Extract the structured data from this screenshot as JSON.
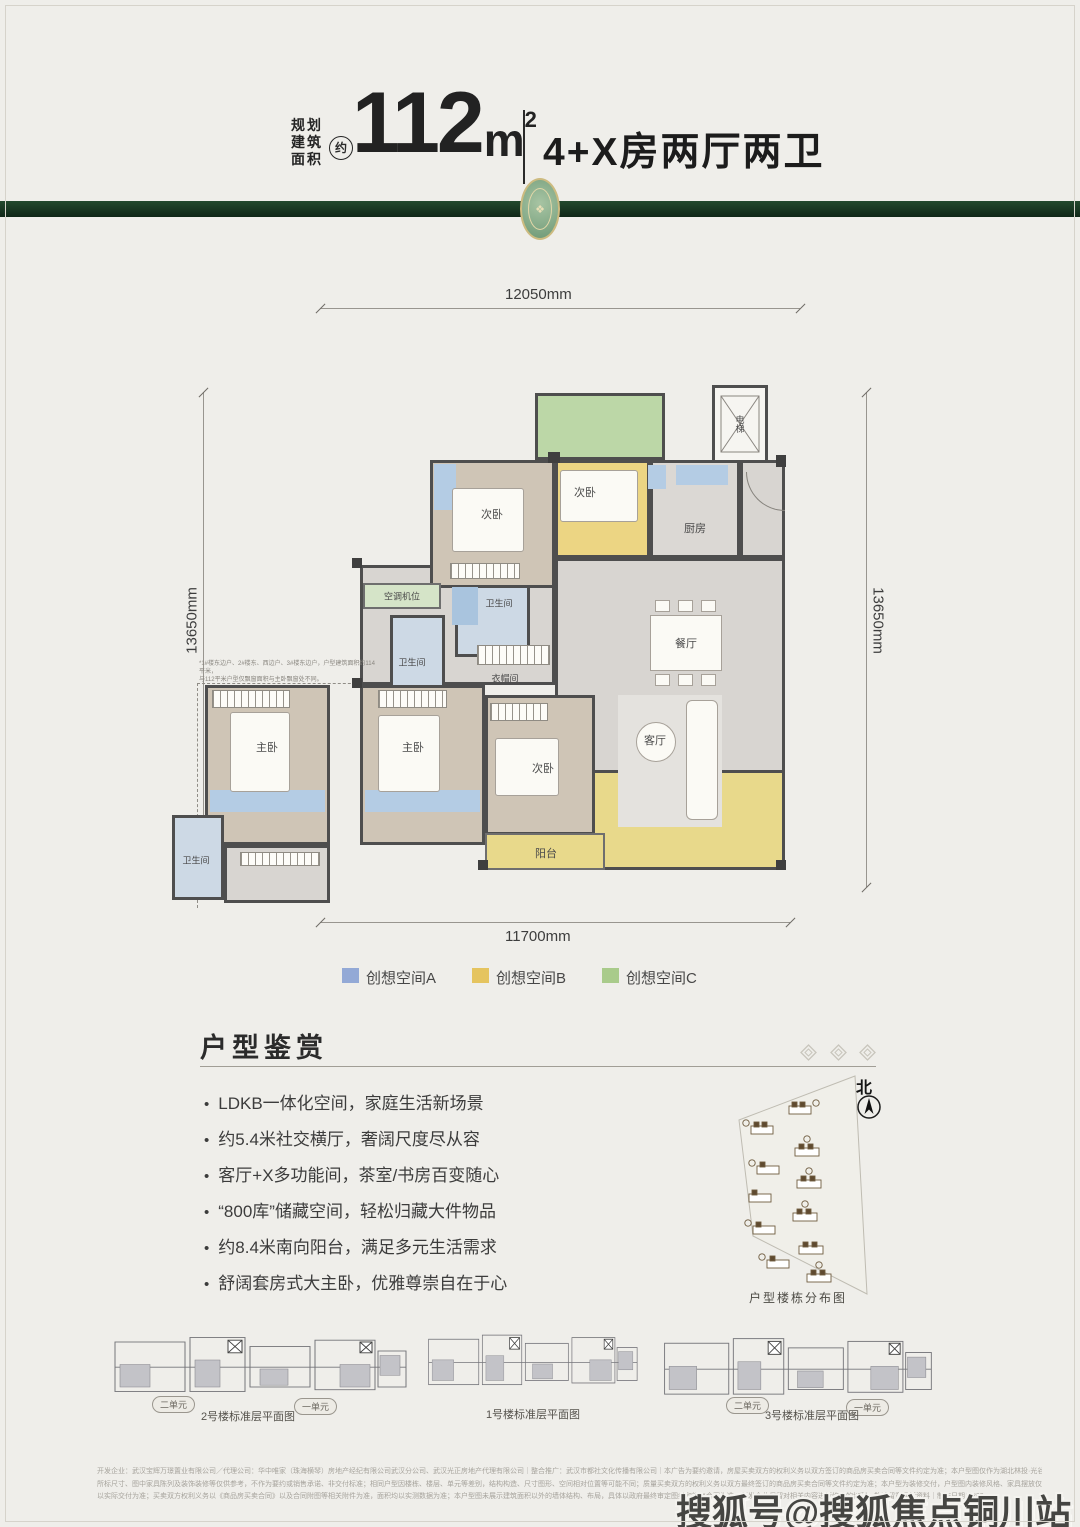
{
  "header": {
    "area_label": [
      "规划",
      "建筑",
      "面积"
    ],
    "approx_badge": "约",
    "area_value": "112",
    "area_unit": "m",
    "area_exp": "2",
    "layout_title": "4+X房两厅两卫"
  },
  "colors": {
    "band_green": "#1b3a24",
    "space_a_blue": "#93a9d6",
    "space_b_yellow": "#e5c45f",
    "space_c_green": "#a9cb8b",
    "wall": "#4e4e4e"
  },
  "floorplan": {
    "dims": {
      "top": "12050mm",
      "left": "13650mm",
      "right": "13650mm",
      "bottom": "11700mm"
    },
    "rooms": {
      "bedroom_left": "次卧",
      "bedroom_yellow": "次卧",
      "kitchen": "厨房",
      "elevator": "电梯",
      "ac_unit": "空调机位",
      "bath_upper": "卫生间",
      "bath_lower": "卫生间",
      "bath_alt": "卫生间",
      "cloakroom": "衣帽间",
      "dining": "餐厅",
      "living": "客厅",
      "master_alt": "主卧",
      "master": "主卧",
      "bedroom_lower": "次卧",
      "balcony": "阳台"
    },
    "note_lines": [
      "*1#楼东边户、2#楼东、西边户、3#楼东边户，户型建筑面积约114平米，",
      "与112平米户型仅飘窗面积与主卧飘窗处不同。"
    ]
  },
  "legend": {
    "items": [
      {
        "label": "创想空间A",
        "color": "#93a9d6"
      },
      {
        "label": "创想空间B",
        "color": "#e5c45f"
      },
      {
        "label": "创想空间C",
        "color": "#a9cb8b"
      }
    ]
  },
  "section": {
    "title": "户型鉴赏",
    "bullets": [
      "LDKB一体化空间，家庭生活新场景",
      "约5.4米社交横厅，奢阔尺度尽从容",
      "客厅+X多功能间，茶室/书房百变随心",
      "“800库”储藏空间，轻松归藏大件物品",
      "约8.4米南向阳台，满足多元生活需求",
      "舒阔套房式大主卧，优雅尊崇自在于心"
    ]
  },
  "siteplan": {
    "north_label": "北",
    "caption": "户型楼栋分布图"
  },
  "thumbnails": [
    {
      "caption": "2号楼标准层平面图",
      "units": [
        "二单元",
        "一单元"
      ]
    },
    {
      "caption": "1号楼标准层平面图",
      "units": []
    },
    {
      "caption": "3号楼标准层平面图",
      "units": [
        "二单元",
        "一单元"
      ]
    }
  ],
  "disclaimer": [
    "开发企业：武汉宝辉万璟置业有限公司／代理公司：华中唯家（珠海横琴）房地产经纪有限公司武汉分公司、武汉光正房地产代理有限公司｜整合推广：武汉市都社文化传播有限公司｜本广告为要约邀请，房屋买卖双方的权利义务以双方签订的商品房买卖合同等文件约定为准；本户型图仅作为湖北林投·光谷锦上项目户型结构大致情况示意，",
    "所标尺寸、图中家具陈列及装饰装修等仅供参考，不作为要约或销售承诺、非交付标准；相同户型因楼栋、楼层、单元等差别，结构构造、尺寸图形、空间相对位置等可能不同；质量买卖双方的权利义务以双方最终签订的商品房买卖合同等文件约定为准；本户型为装修交付，户型图内装修风格、家具摆放仅在为客户提供参考，非交付标准，最终呈现",
    "以实际交付为准；买卖双方权利义务以《商品房买卖合同》以及合同附图等相关附件为准，面积均以实测数据为准；本户型图未展示建筑面积以外的墙体结构、布局，具体以政府最终审定图纸和销售合同为准；开发企业保留对相关内容进行修改的权利，敬请留意最新资料｜制作日期：202"
  ],
  "watermark": "搜狐号@搜狐焦点铜川站"
}
